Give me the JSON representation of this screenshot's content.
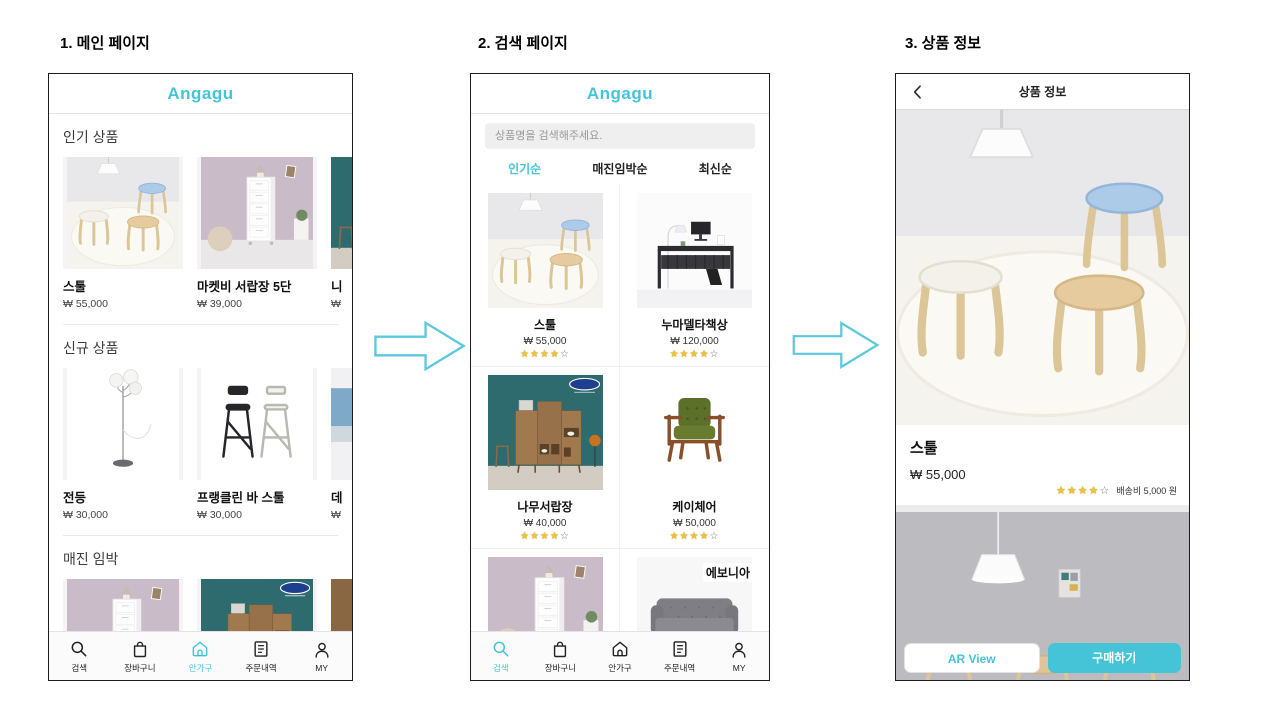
{
  "colors": {
    "accent": "#45c4d8",
    "star_filled": "#f2c230"
  },
  "nav": {
    "items": [
      {
        "label": "검색",
        "icon": "search-icon"
      },
      {
        "label": "장바구니",
        "icon": "bag-icon"
      },
      {
        "label": "안가구",
        "icon": "home-icon"
      },
      {
        "label": "주문내역",
        "icon": "orders-icon"
      },
      {
        "label": "MY",
        "icon": "person-icon"
      }
    ]
  },
  "main_page": {
    "caption": "1. 메인 페이지",
    "app_title": "Angagu",
    "active_tab": "안가구",
    "sections": [
      {
        "title": "인기 상품",
        "items": [
          {
            "name": "스툴",
            "price": "₩ 55,000",
            "image": "stools"
          },
          {
            "name": "마켓비 서랍장 5단",
            "price": "₩ 39,000",
            "image": "drawer-white"
          },
          {
            "name": "니",
            "price": "₩",
            "image": "wood-cabinet",
            "partial": true
          }
        ]
      },
      {
        "title": "신규 상품",
        "items": [
          {
            "name": "전등",
            "price": "₩ 30,000",
            "image": "floor-lamp"
          },
          {
            "name": "프랭클린 바 스툴",
            "price": "₩ 30,000",
            "image": "bar-stools"
          },
          {
            "name": "데",
            "price": "₩",
            "image": "partial-blue",
            "partial": true
          }
        ]
      },
      {
        "title": "매진 임박",
        "items": [
          {
            "image": "drawer-white"
          },
          {
            "image": "wood-cabinet"
          },
          {
            "image": "partial-wood",
            "partial": true
          }
        ]
      }
    ]
  },
  "search_page": {
    "caption": "2. 검색 페이지",
    "app_title": "Angagu",
    "active_tab": "검색",
    "search_placeholder": "상품명을 검색해주세요.",
    "sort_tabs": [
      {
        "label": "인기순",
        "active": true
      },
      {
        "label": "매진임박순",
        "active": false
      },
      {
        "label": "최신순",
        "active": false
      }
    ],
    "products": [
      {
        "name": "스툴",
        "price": "₩ 55,000",
        "rating": 4,
        "image": "stools"
      },
      {
        "name": "누마델타책상",
        "price": "₩ 120,000",
        "rating": 4,
        "image": "desk"
      },
      {
        "name": "나무서랍장",
        "price": "₩ 40,000",
        "rating": 4,
        "image": "wood-cabinet"
      },
      {
        "name": "케이체어",
        "price": "₩ 50,000",
        "rating": 4,
        "image": "green-chair"
      },
      {
        "image": "drawer-white",
        "partial": true
      },
      {
        "image": "sofa",
        "brand_overlay": "에보니아",
        "partial": true
      }
    ]
  },
  "detail_page": {
    "caption": "3. 상품 정보",
    "header_title": "상품 정보",
    "product": {
      "name": "스툴",
      "price": "₩ 55,000",
      "rating": 4,
      "shipping_label": "배송비 5,000 원"
    },
    "buttons": {
      "ar": "AR View",
      "buy": "구매하기"
    }
  }
}
